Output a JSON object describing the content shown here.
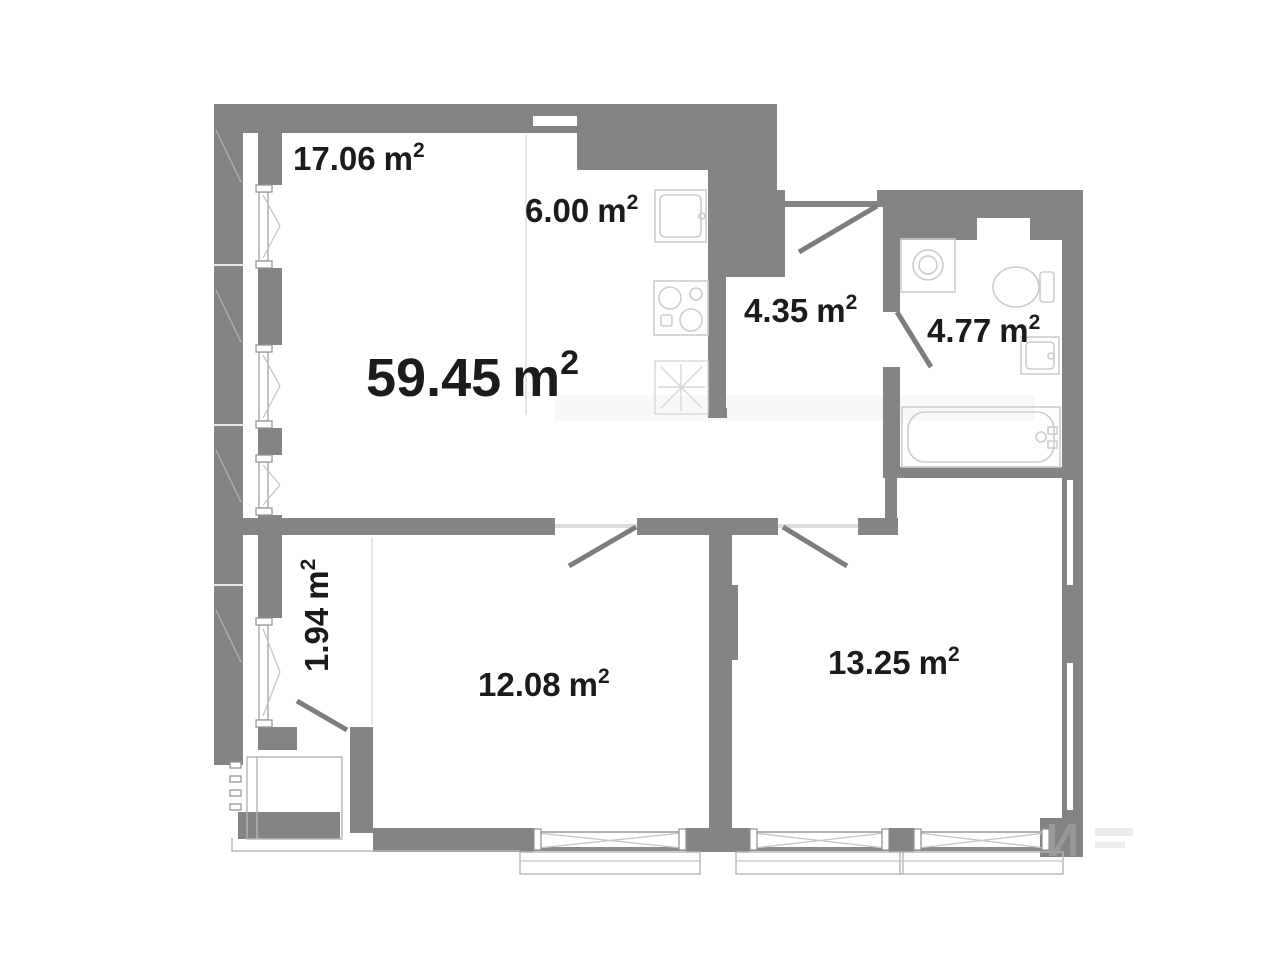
{
  "floor_plan": {
    "total_area": {
      "value": "59.45",
      "unit": "m",
      "sup": "2"
    },
    "rooms": {
      "living": {
        "value": "17.06",
        "unit": "m",
        "sup": "2"
      },
      "kitchen": {
        "value": "6.00",
        "unit": "m",
        "sup": "2"
      },
      "hallway": {
        "value": "4.35",
        "unit": "m",
        "sup": "2"
      },
      "bathroom": {
        "value": "4.77",
        "unit": "m",
        "sup": "2"
      },
      "wardrobe": {
        "value": "1.94",
        "unit": "m",
        "sup": "2"
      },
      "bedroom_left": {
        "value": "12.08",
        "unit": "m",
        "sup": "2"
      },
      "bedroom_right": {
        "value": "13.25",
        "unit": "m",
        "sup": "2"
      }
    },
    "watermark": "И",
    "colors": {
      "wall": "#848484",
      "fixture_outline": "#cdcdcd",
      "text": "#1b1b1b",
      "background": "#ffffff"
    }
  }
}
